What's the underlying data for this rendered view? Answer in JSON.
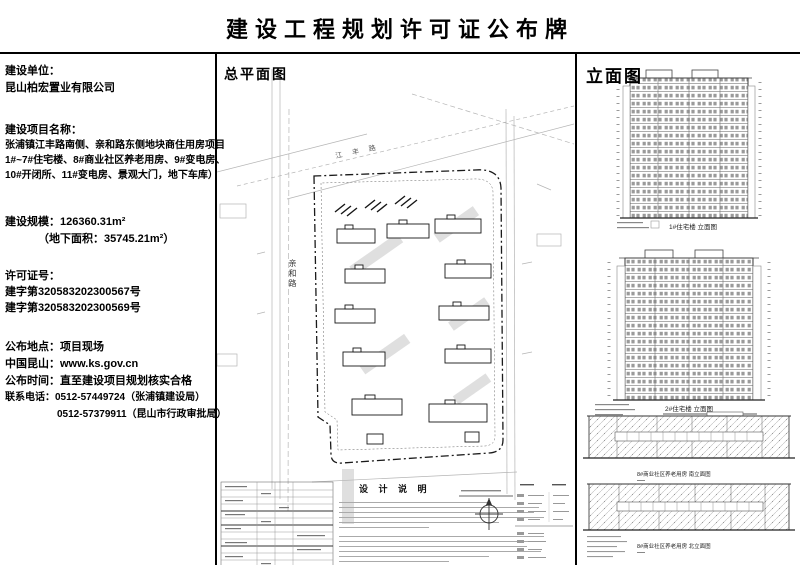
{
  "page": {
    "title": "建设工程规划许可证公布牌"
  },
  "info_panel": {
    "unit_label": "建设单位：",
    "unit_value": "昆山柏宏置业有限公司",
    "project_label": "建设项目名称：",
    "project_lines": [
      "张浦镇江丰路南侧、亲和路东侧地块商住用房项目",
      "1#~7#住宅楼、8#商业社区养老用房、9#变电房、",
      "10#开闭所、11#变电房、景观大门，地下车库）"
    ],
    "scale_label": "建设规模：",
    "scale_value": "126360.31m²",
    "scale_sub": "（地下面积：35745.21m²）",
    "permit_label": "许可证号：",
    "permit_numbers": [
      "建字第320583202300567号",
      "建字第320583202300569号"
    ],
    "location_label": "公布地点：",
    "location_value": "项目现场",
    "website_label": "中国昆山：",
    "website_value": "www.ks.gov.cn",
    "duration_label": "公布时间：",
    "duration_value": "直至建设项目规划核实合格",
    "phone_label": "联系电话：",
    "phone1": "0512-57449724（张浦镇建设局）",
    "phone2": "0512-57379911（昆山市行政审批局）"
  },
  "site_plan": {
    "title": "总平面图",
    "road_left": "亲和路",
    "road_top": "江丰路",
    "notes_title": "设 计 说 明"
  },
  "elevation": {
    "title": "立面图",
    "captions": [
      "1#住宅楼 立面图",
      "2#住宅楼 立面图",
      "8#商业社区养老用房 南立面图",
      "8#商业社区养老用房 北立面图"
    ]
  }
}
